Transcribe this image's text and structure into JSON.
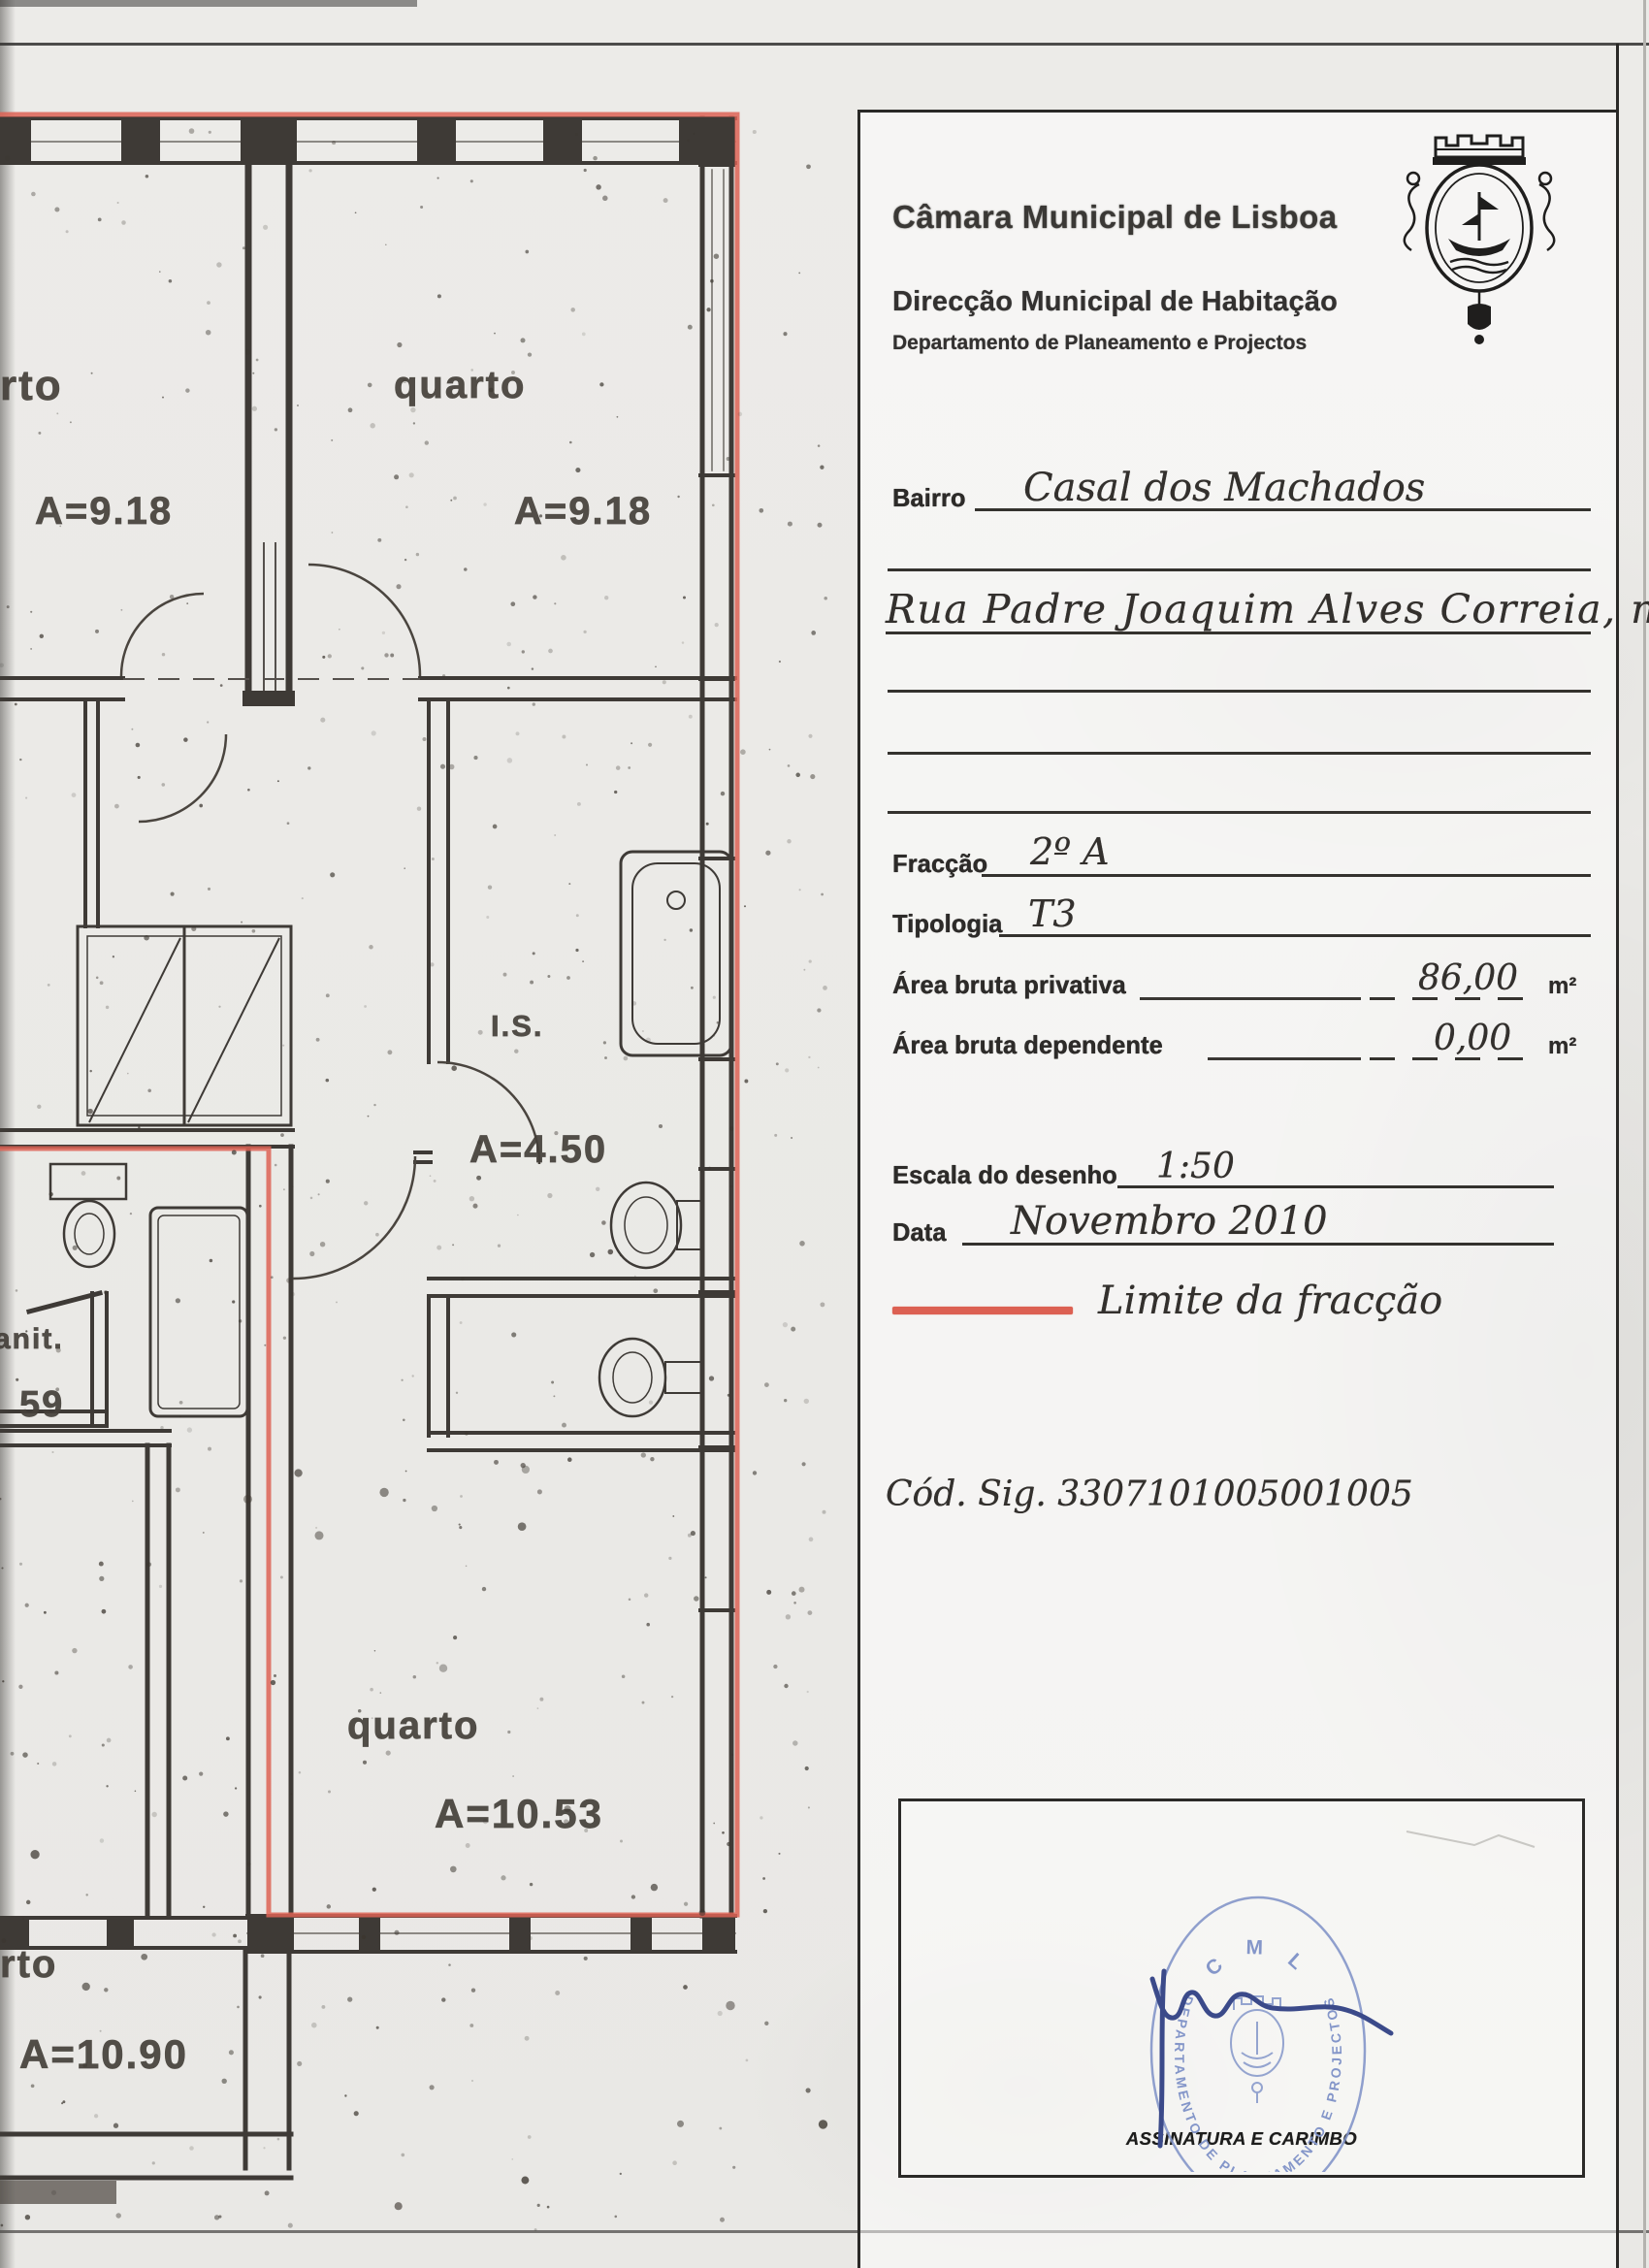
{
  "header": {
    "org": "Câmara Municipal de Lisboa",
    "division": "Direcção Municipal de Habitação",
    "department": "Departamento de Planeamento e Projectos",
    "crest_icon": "lisbon-municipal-coat-of-arms"
  },
  "form": {
    "bairro_label": "Bairro",
    "bairro_value": "Casal dos Machados",
    "address_value": "Rua Padre Joaquim Alves Correia, nº 6",
    "fraccao_label": "Fracção",
    "fraccao_value": "2º A",
    "tipologia_label": "Tipologia",
    "tipologia_value": "T3",
    "abp_label": "Área bruta privativa",
    "abp_value": "86,00",
    "abp_unit": "m²",
    "abd_label": "Área bruta dependente",
    "abd_value": "0,00",
    "abd_unit": "m²",
    "escala_label": "Escala do desenho",
    "escala_value": "1:50",
    "data_label": "Data",
    "data_value": "Novembro 2010",
    "legend_label": "Limite da fracção",
    "cod_sig_label": "Cód. Sig.",
    "cod_sig_value": "3307101005001005"
  },
  "signature_box": {
    "caption": "ASSINATURA E CARIMBO",
    "stamp_top": "C M L",
    "stamp_ring": "DEPARTAMENTO DE PLANEAMENTO E PROJECTOS",
    "stamp_color": "#8496c9",
    "signature_color": "#3b4a8a"
  },
  "plan": {
    "limit_color": "#dd6355",
    "rooms": [
      {
        "label": "rto",
        "area": "A=9.18"
      },
      {
        "label": "quarto",
        "area": "A=9.18"
      },
      {
        "label": "I.S.",
        "area": "A=4.50"
      },
      {
        "label": "quarto",
        "area": "A=10.53"
      },
      {
        "label": "rto",
        "area": "A=10.90"
      },
      {
        "label": "anit.",
        "area": "59"
      }
    ]
  }
}
